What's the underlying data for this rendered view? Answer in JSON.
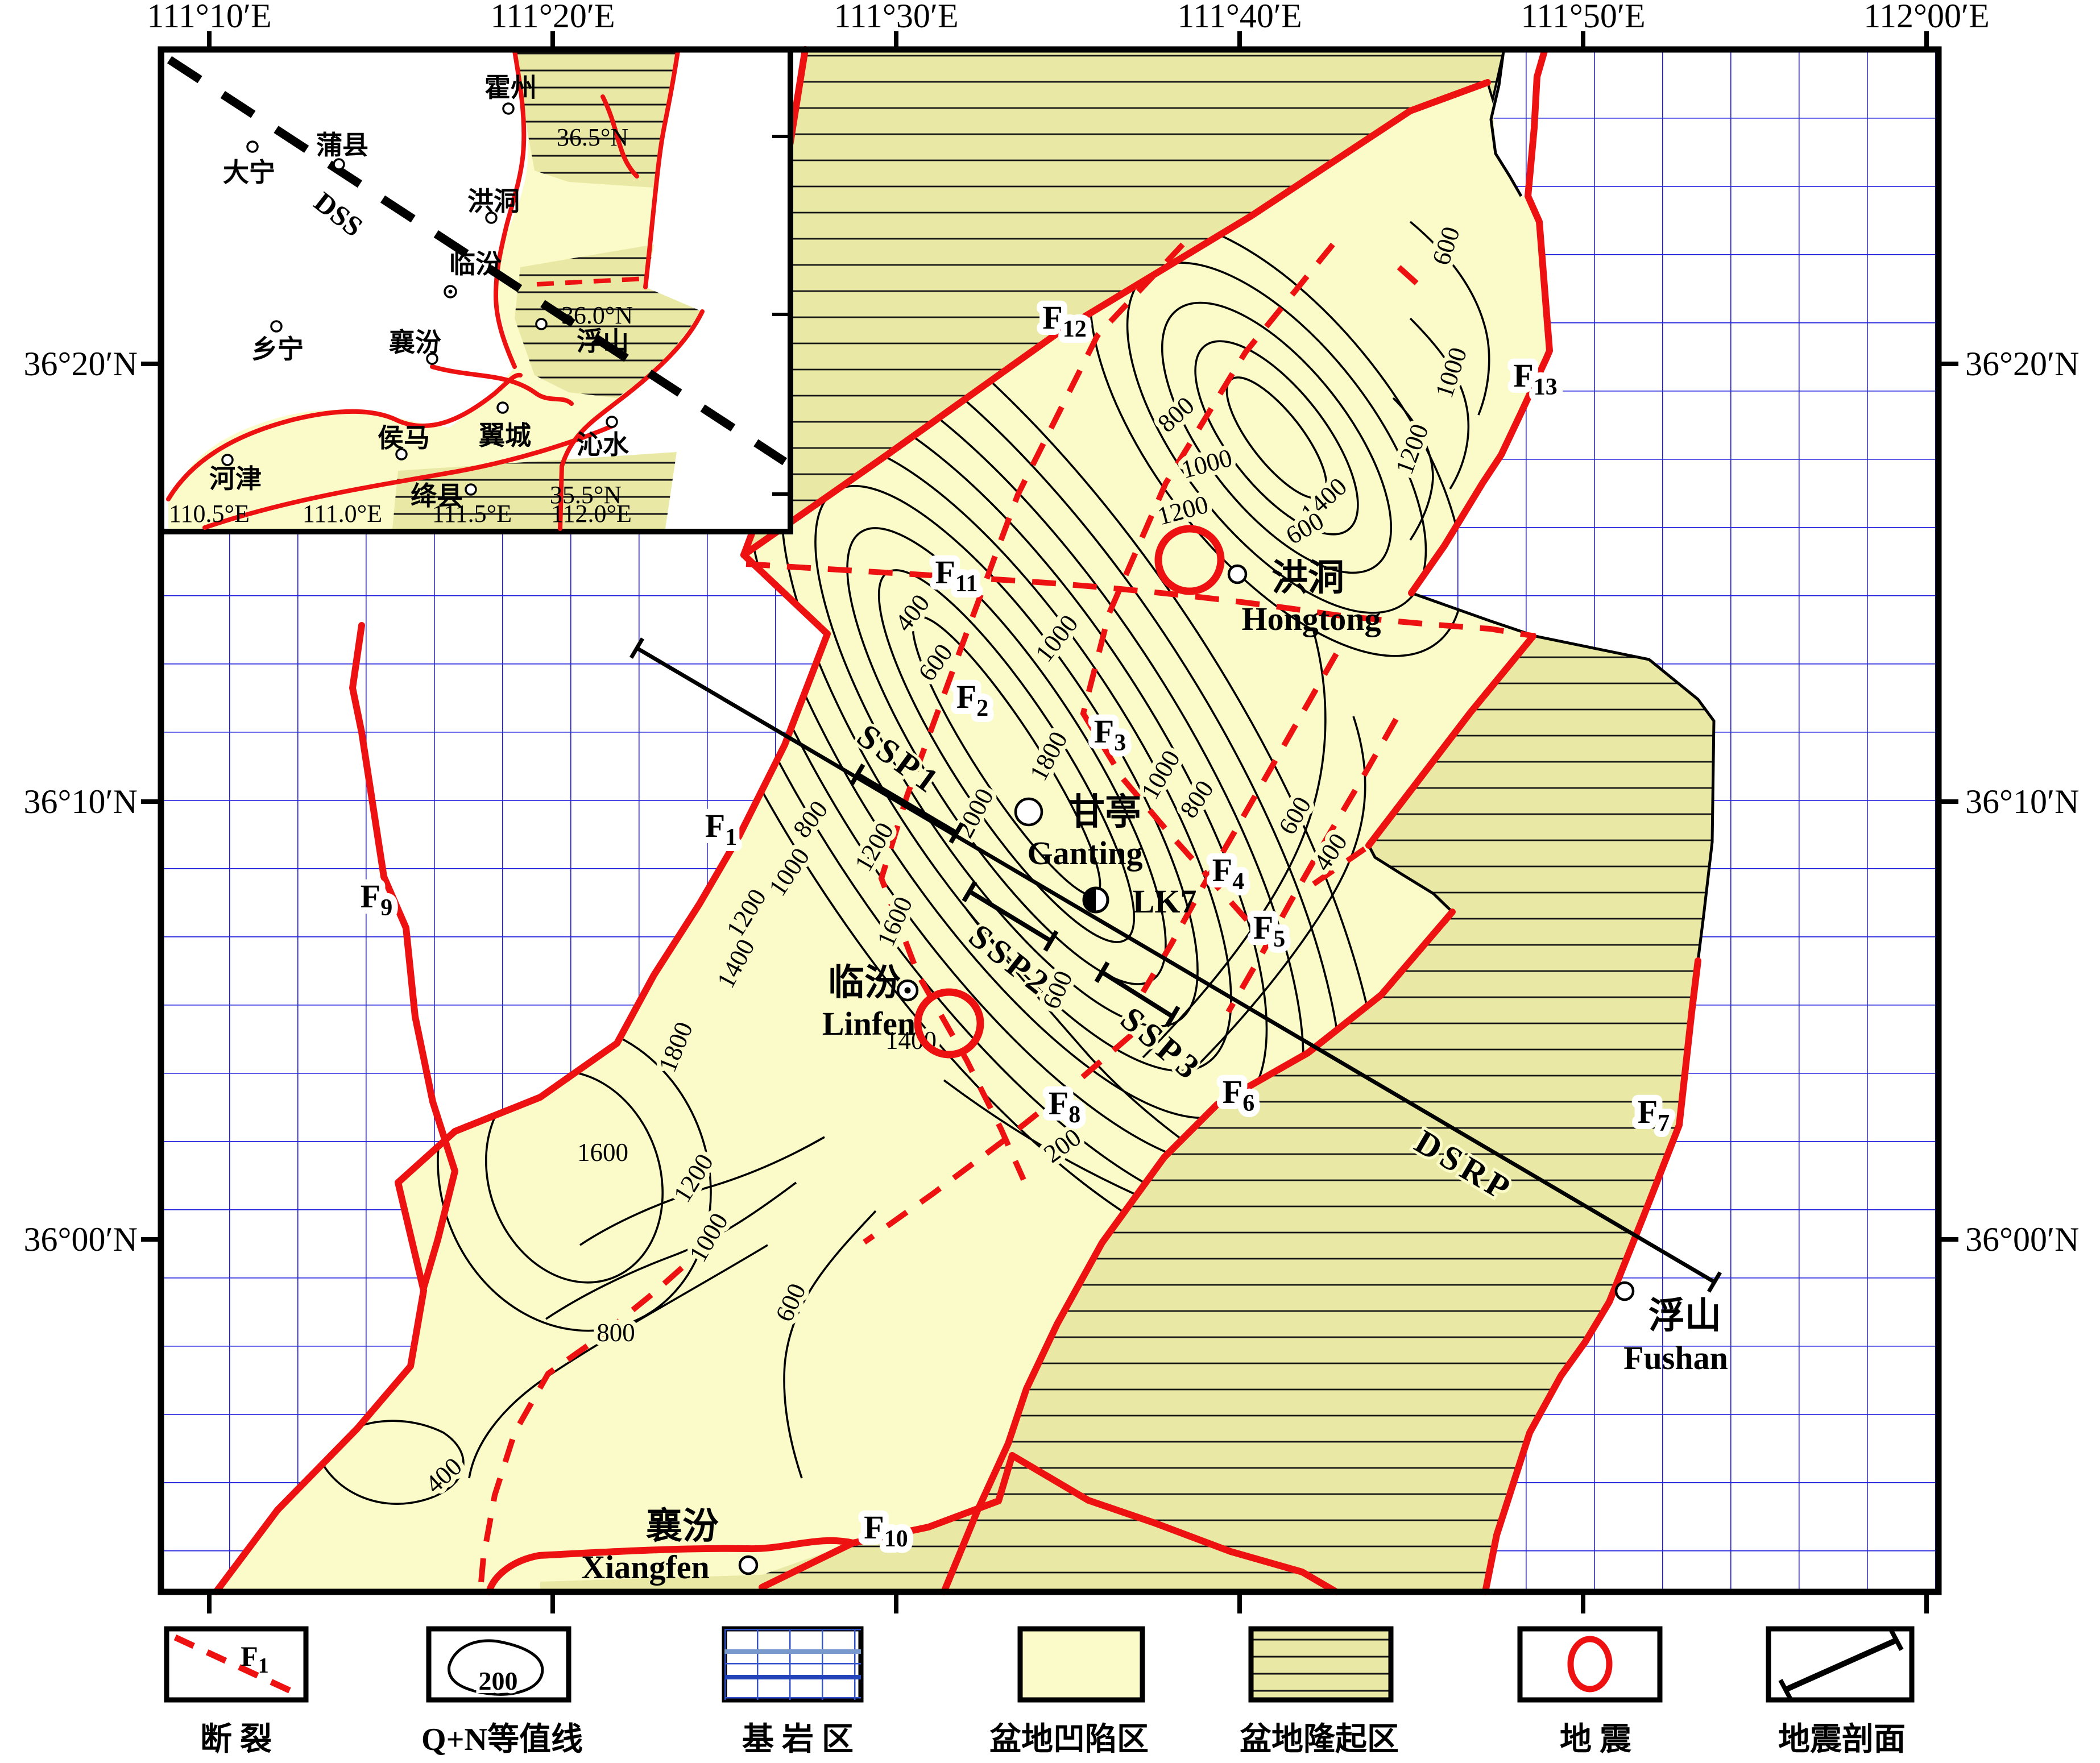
{
  "axes": {
    "top": [
      "111°10′E",
      "111°20′E",
      "111°30′E",
      "111°40′E",
      "111°50′E",
      "112°00′E"
    ],
    "left": [
      "36°20′N",
      "36°10′N",
      "36°00′N"
    ],
    "right": [
      "36°20′N",
      "36°10′N",
      "36°00′N"
    ]
  },
  "inset": {
    "profile": "DSS",
    "lat": [
      "36.5°N",
      "36.0°N",
      "35.5°N"
    ],
    "lon": [
      "110.5°E",
      "111.0°E",
      "111.5°E",
      "112.0°E"
    ],
    "cities": [
      "霍州",
      "蒲县",
      "大宁",
      "洪洞",
      "临汾",
      "乡宁",
      "襄汾",
      "浮山",
      "侯马",
      "翼城",
      "沁水",
      "河津",
      "绛县"
    ]
  },
  "faults": {
    "f1": {
      "p": "F",
      "s": "1"
    },
    "f2": {
      "p": "F",
      "s": "2"
    },
    "f3": {
      "p": "F",
      "s": "3"
    },
    "f4": {
      "p": "F",
      "s": "4"
    },
    "f5": {
      "p": "F",
      "s": "5"
    },
    "f6": {
      "p": "F",
      "s": "6"
    },
    "f7": {
      "p": "F",
      "s": "7"
    },
    "f8": {
      "p": "F",
      "s": "8"
    },
    "f9": {
      "p": "F",
      "s": "9"
    },
    "f10": {
      "p": "F",
      "s": "10"
    },
    "f11": {
      "p": "F",
      "s": "11"
    },
    "f12": {
      "p": "F",
      "s": "12"
    },
    "f13": {
      "p": "F",
      "s": "13"
    }
  },
  "profiles": {
    "dsrp": "DSRP",
    "ssp1": "SSP1",
    "ssp2": "SSP2",
    "ssp3": "SSP3"
  },
  "cities": {
    "hongtong": {
      "zh": "洪洞",
      "en": "Hongtong"
    },
    "ganting": {
      "zh": "甘亭",
      "en": "Ganting"
    },
    "linfen": {
      "zh": "临汾",
      "en": "Linfen"
    },
    "xiangfen": {
      "zh": "襄汾",
      "en": "Xiangfen"
    },
    "fushan": {
      "zh": "浮山",
      "en": "Fushan"
    }
  },
  "well": {
    "label": "LK7"
  },
  "contours": {
    "c200": "200",
    "c400": "400",
    "c600": "600",
    "c800": "800",
    "c1000": "1000",
    "c1200": "1200",
    "c1400": "1400",
    "c1600": "1600",
    "c1800": "1800",
    "c2000": "2000"
  },
  "contour_values": [
    200,
    400,
    600,
    800,
    1000,
    1200,
    1400,
    1600,
    1800,
    2000
  ],
  "legend": {
    "items": [
      {
        "label": "断  裂",
        "symbol": "fault",
        "fp": "F",
        "fs": "1"
      },
      {
        "label": "Q+N等值线",
        "symbol": "contour",
        "value": "200"
      },
      {
        "label": "基 岩 区",
        "symbol": "bedrock"
      },
      {
        "label": "盆地凹陷区",
        "symbol": "depression"
      },
      {
        "label": "盆地隆起区",
        "symbol": "uplift"
      },
      {
        "label": "地  震",
        "symbol": "earthquake"
      },
      {
        "label": "地震剖面",
        "symbol": "profile"
      }
    ]
  },
  "colors": {
    "depression": "#FBFBC9",
    "uplift": "#E9E9A5",
    "fault_red": "#EE1111",
    "grid_blue": "#2222DD"
  }
}
